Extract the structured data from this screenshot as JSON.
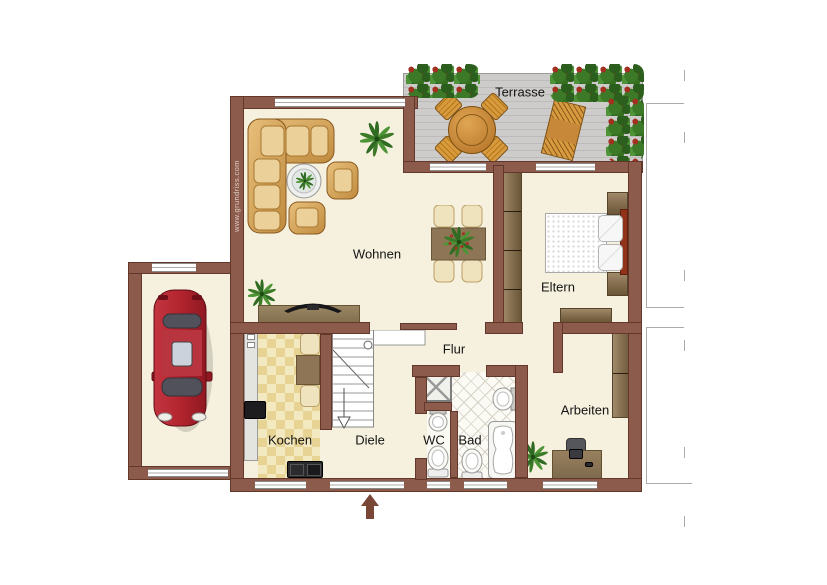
{
  "meta": {
    "watermark": "www.grundriss.com"
  },
  "rooms": {
    "terrasse": "Terrasse",
    "wohnen": "Wohnen",
    "eltern": "Eltern",
    "flur": "Flur",
    "kochen": "Kochen",
    "diele": "Diele",
    "wc": "WC",
    "bad": "Bad",
    "arbeiten": "Arbeiten"
  },
  "colors": {
    "wall": "#8d5b4c",
    "floor": "#f6f1de",
    "terrace_deck": "#cdccca",
    "hedge_green": "#3c7a28",
    "car_red": "#b3242e",
    "sofa_wood": "#d9a85f",
    "cabinet_brown": "#8a7355",
    "kitchen_tile": "#e7d494"
  }
}
